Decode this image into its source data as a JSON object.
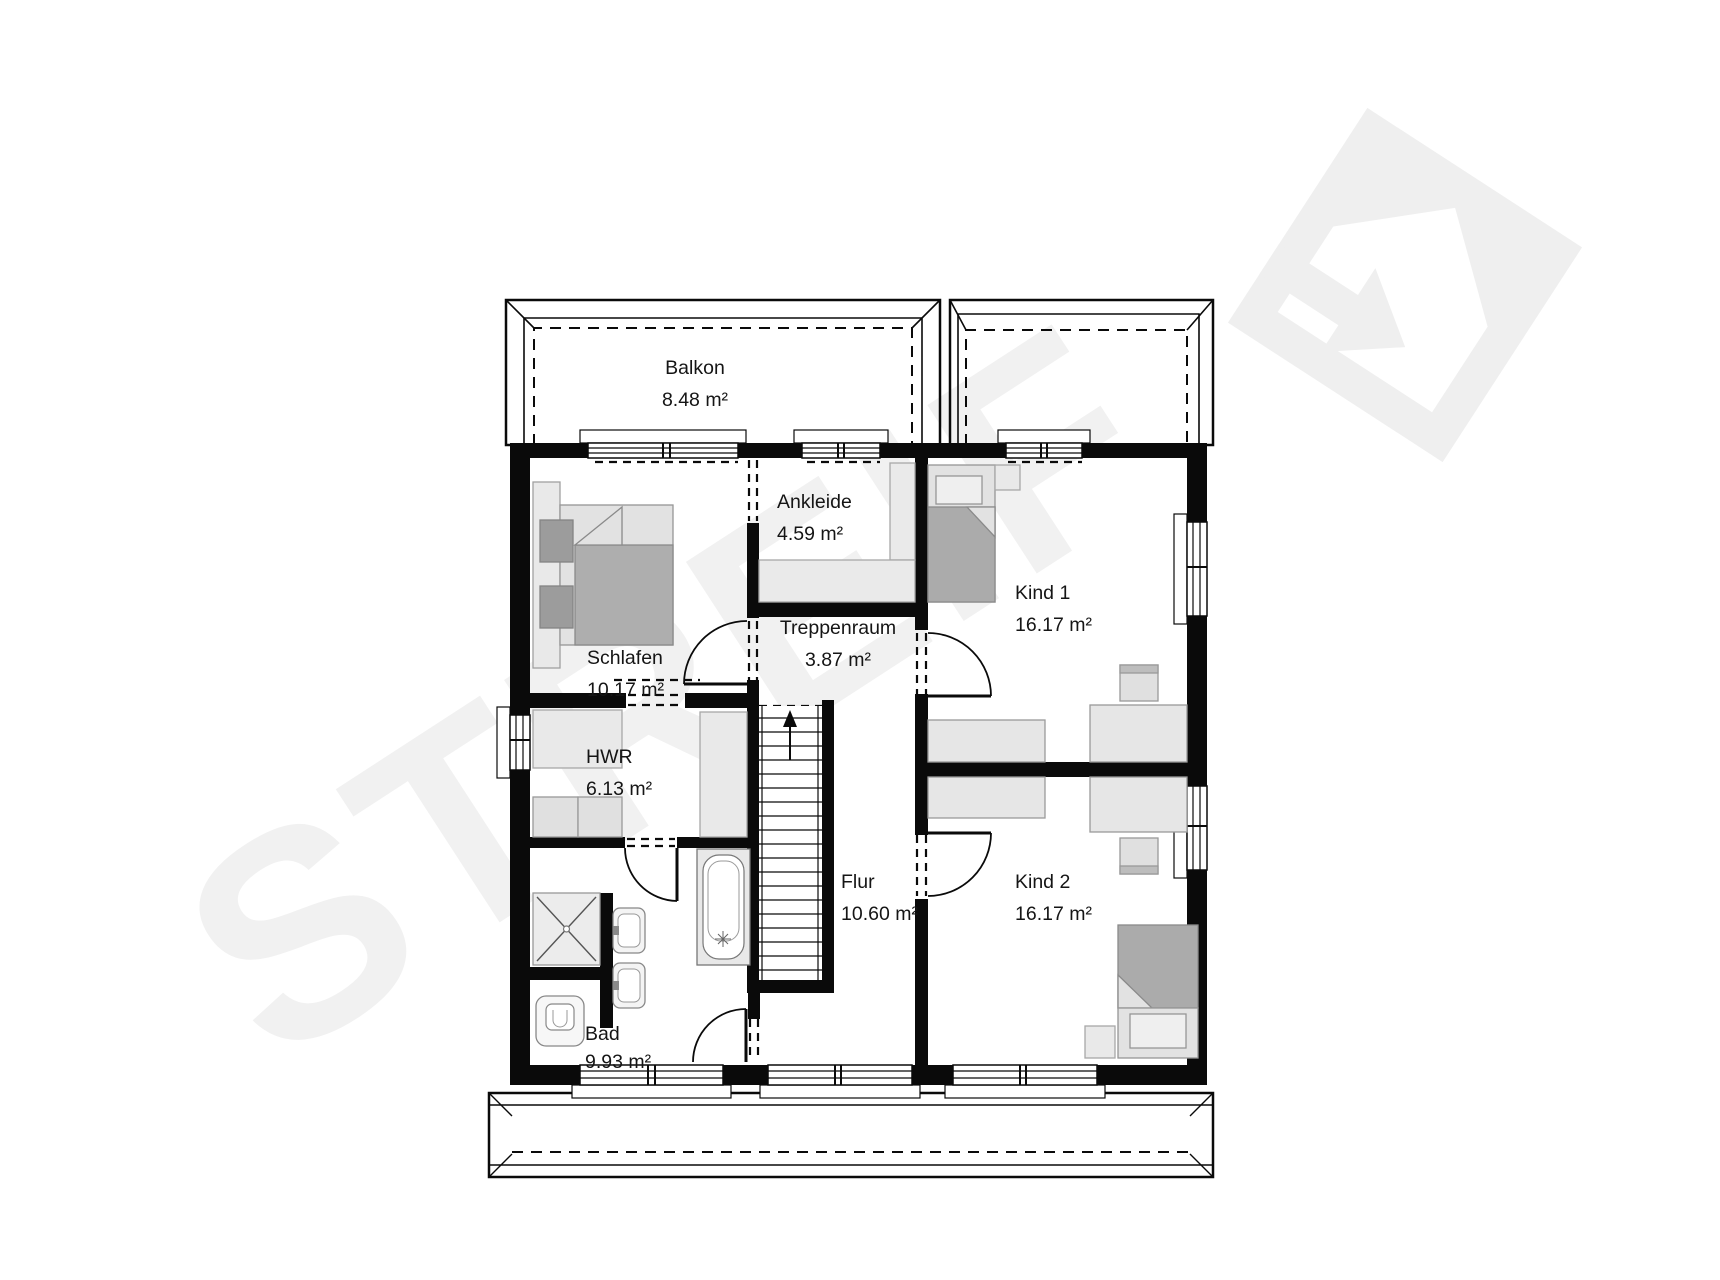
{
  "watermark": {
    "brand": "STREIF"
  },
  "rooms": {
    "balkon": {
      "name": "Balkon",
      "area": "8.48 m²"
    },
    "ankleide": {
      "name": "Ankleide",
      "area": "4.59 m²"
    },
    "kind1": {
      "name": "Kind 1",
      "area": "16.17 m²"
    },
    "schlafen": {
      "name": "Schlafen",
      "area": "10.17 m²"
    },
    "treppenraum": {
      "name": "Treppenraum",
      "area": "3.87 m²"
    },
    "hwr": {
      "name": "HWR",
      "area": "6.13 m²"
    },
    "flur": {
      "name": "Flur",
      "area": "10.60 m²"
    },
    "kind2": {
      "name": "Kind 2",
      "area": "16.17 m²"
    },
    "bad": {
      "name": "Bad",
      "area": "9.93 m²"
    }
  },
  "colors": {
    "wall": "#0a0a0a",
    "furniture_light": "#e6e6e6",
    "furniture_dark": "#ababab",
    "pillow_dark": "#9c9c9c",
    "watermark": "#f1f1f1",
    "logo": "#efefef"
  }
}
